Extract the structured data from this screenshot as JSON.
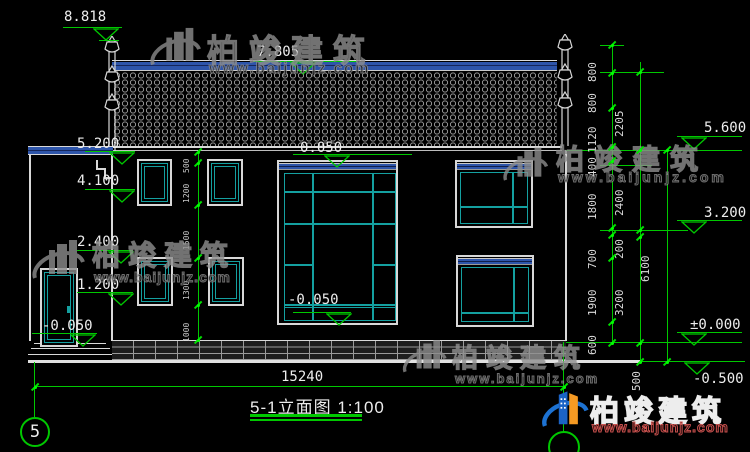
{
  "drawing": {
    "title_text": "5-1立面图",
    "title_scale": "1:100",
    "axis_bubble_left": "5",
    "overall_width": "15240"
  },
  "levels": {
    "finial_top": "8.818",
    "ridge": "7.805",
    "eave_offset": "0.050",
    "annex_roof": "5.200",
    "l4100": "4.100",
    "l2400": "2.400",
    "l1200": "1.200",
    "door_ground": "-0.050",
    "lobby_floor": "-0.050",
    "right_eave": "5.600",
    "r3200": "3.200",
    "zero": "±0.000",
    "minus500": "-0.500"
  },
  "chains": {
    "inner": [
      "500",
      "1200",
      "1500",
      "1300",
      "1000"
    ],
    "right1": [
      "800",
      "800",
      "1120",
      "400",
      "1800",
      "700",
      "1900",
      "600"
    ],
    "right2": [
      "2205",
      "2400",
      "200",
      "3200",
      "500"
    ],
    "right3": [
      "6100"
    ]
  },
  "watermarks": {
    "brand_cn": "柏竣建筑",
    "brand_url": "www.baijunjz.com"
  },
  "colors": {
    "dimension_green": "#00c800",
    "frame_cyan": "#14a0a0",
    "band_blue": "#2e55aa",
    "brand_blue": "#1d72d2",
    "brand_orange": "#f59a23"
  }
}
